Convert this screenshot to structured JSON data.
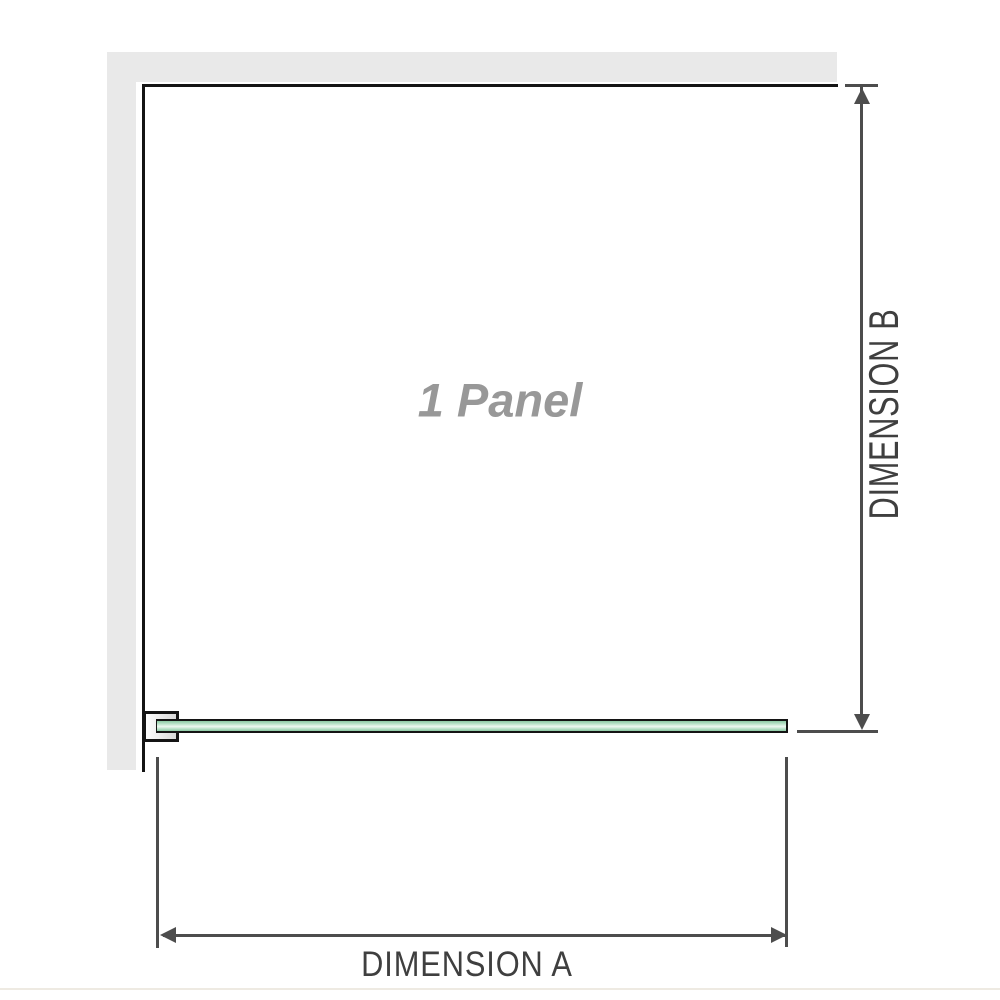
{
  "diagram": {
    "title_label": "1 Panel",
    "dimension_a": {
      "label": "DIMENSION A"
    },
    "dimension_b": {
      "label": "DIMENSION B"
    }
  },
  "colors": {
    "wall": "#e9e9e9",
    "outline": "#141414",
    "dim_line": "#4d4d4d",
    "label_text": "#3f3f3f",
    "panel_label_text": "#989898",
    "glass_edge": "#8cc9a3",
    "glass_mid": "#eef8f1",
    "bottom_rule": "#eeeae2",
    "bg": "#ffffff"
  }
}
